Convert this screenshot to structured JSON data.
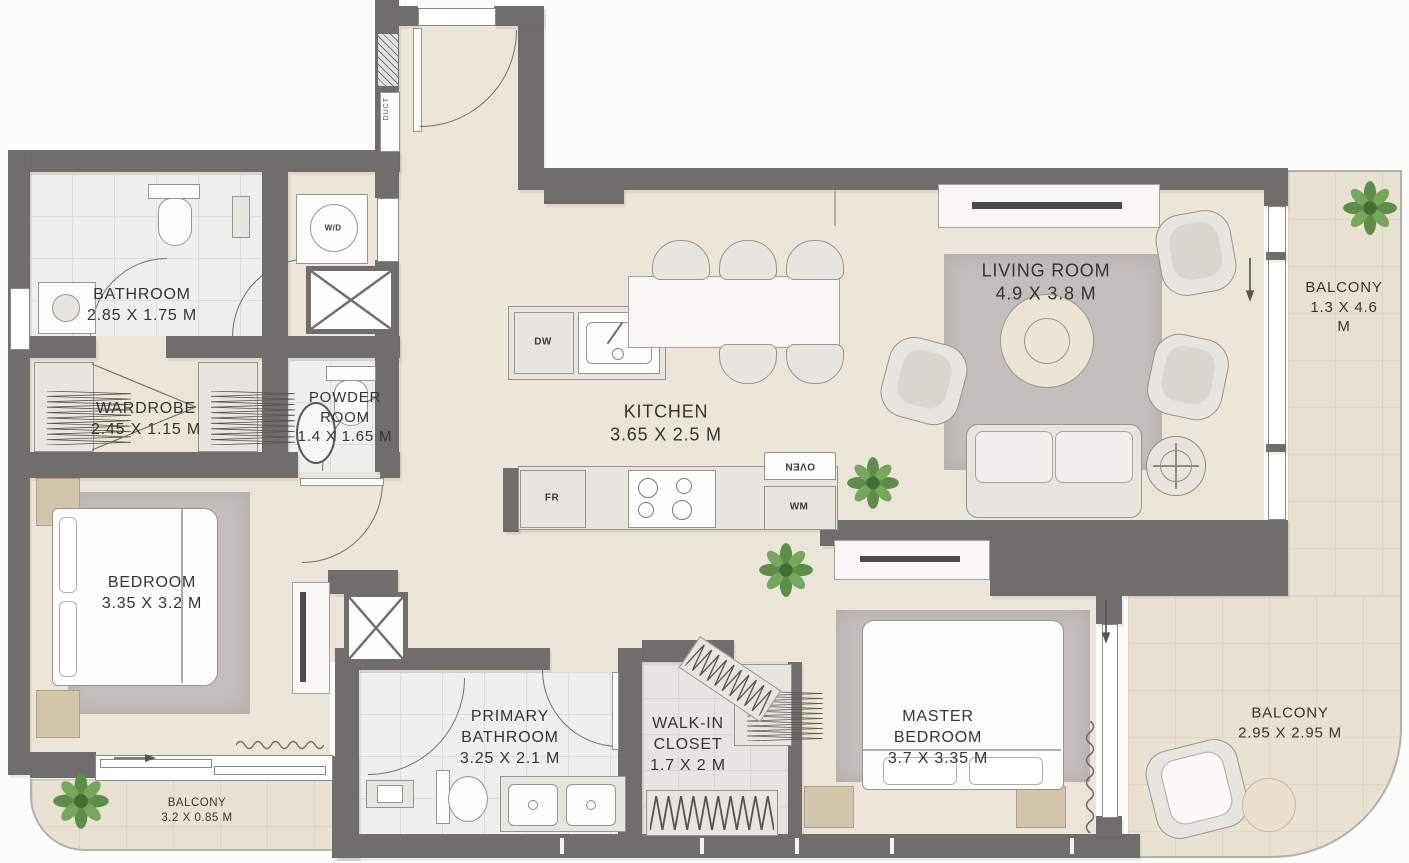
{
  "rooms": [
    {
      "id": "bathroom",
      "name": "BATHROOM",
      "dims": "2.85 X 1.75 M"
    },
    {
      "id": "wardrobe",
      "name": "WARDROBE",
      "dims": "2.45 X 1.15 M"
    },
    {
      "id": "powder-room",
      "name": "POWDER ROOM",
      "dims": "1.4 X 1.65 M"
    },
    {
      "id": "kitchen",
      "name": "KITCHEN",
      "dims": "3.65 X 2.5 M"
    },
    {
      "id": "living-room",
      "name": "LIVING ROOM",
      "dims": "4.9 X 3.8 M"
    },
    {
      "id": "balcony-right",
      "name": "BALCONY",
      "dims": "1.3 X 4.6 M"
    },
    {
      "id": "bedroom",
      "name": "BEDROOM",
      "dims": "3.35 X 3.2 M"
    },
    {
      "id": "primary-bathroom",
      "name": "PRIMARY BATHROOM",
      "dims": "3.25 X 2.1 M"
    },
    {
      "id": "walk-in-closet",
      "name": "WALK-IN CLOSET",
      "dims": "1.7 X 2 M"
    },
    {
      "id": "master-bedroom",
      "name": "MASTER BEDROOM",
      "dims": "3.7 X 3.35 M"
    },
    {
      "id": "balcony-bottom-right",
      "name": "BALCONY",
      "dims": "2.95 X 2.95 M"
    },
    {
      "id": "balcony-bottom-left",
      "name": "BALCONY",
      "dims": "3.2 X 0.85 M"
    }
  ],
  "appliances": {
    "washer_dryer": "W/D",
    "dishwasher": "DW",
    "fridge": "FR",
    "washing_machine": "WM",
    "oven": "OVEN",
    "duct": "DUCT"
  },
  "colors": {
    "wall": "#6f6e6c",
    "floor": "#ece5d9",
    "balcony_floor": "#e9e2d3",
    "bath_floor": "#eef0ee",
    "rug": "#c2bebb",
    "plant": "#5e8c49"
  }
}
